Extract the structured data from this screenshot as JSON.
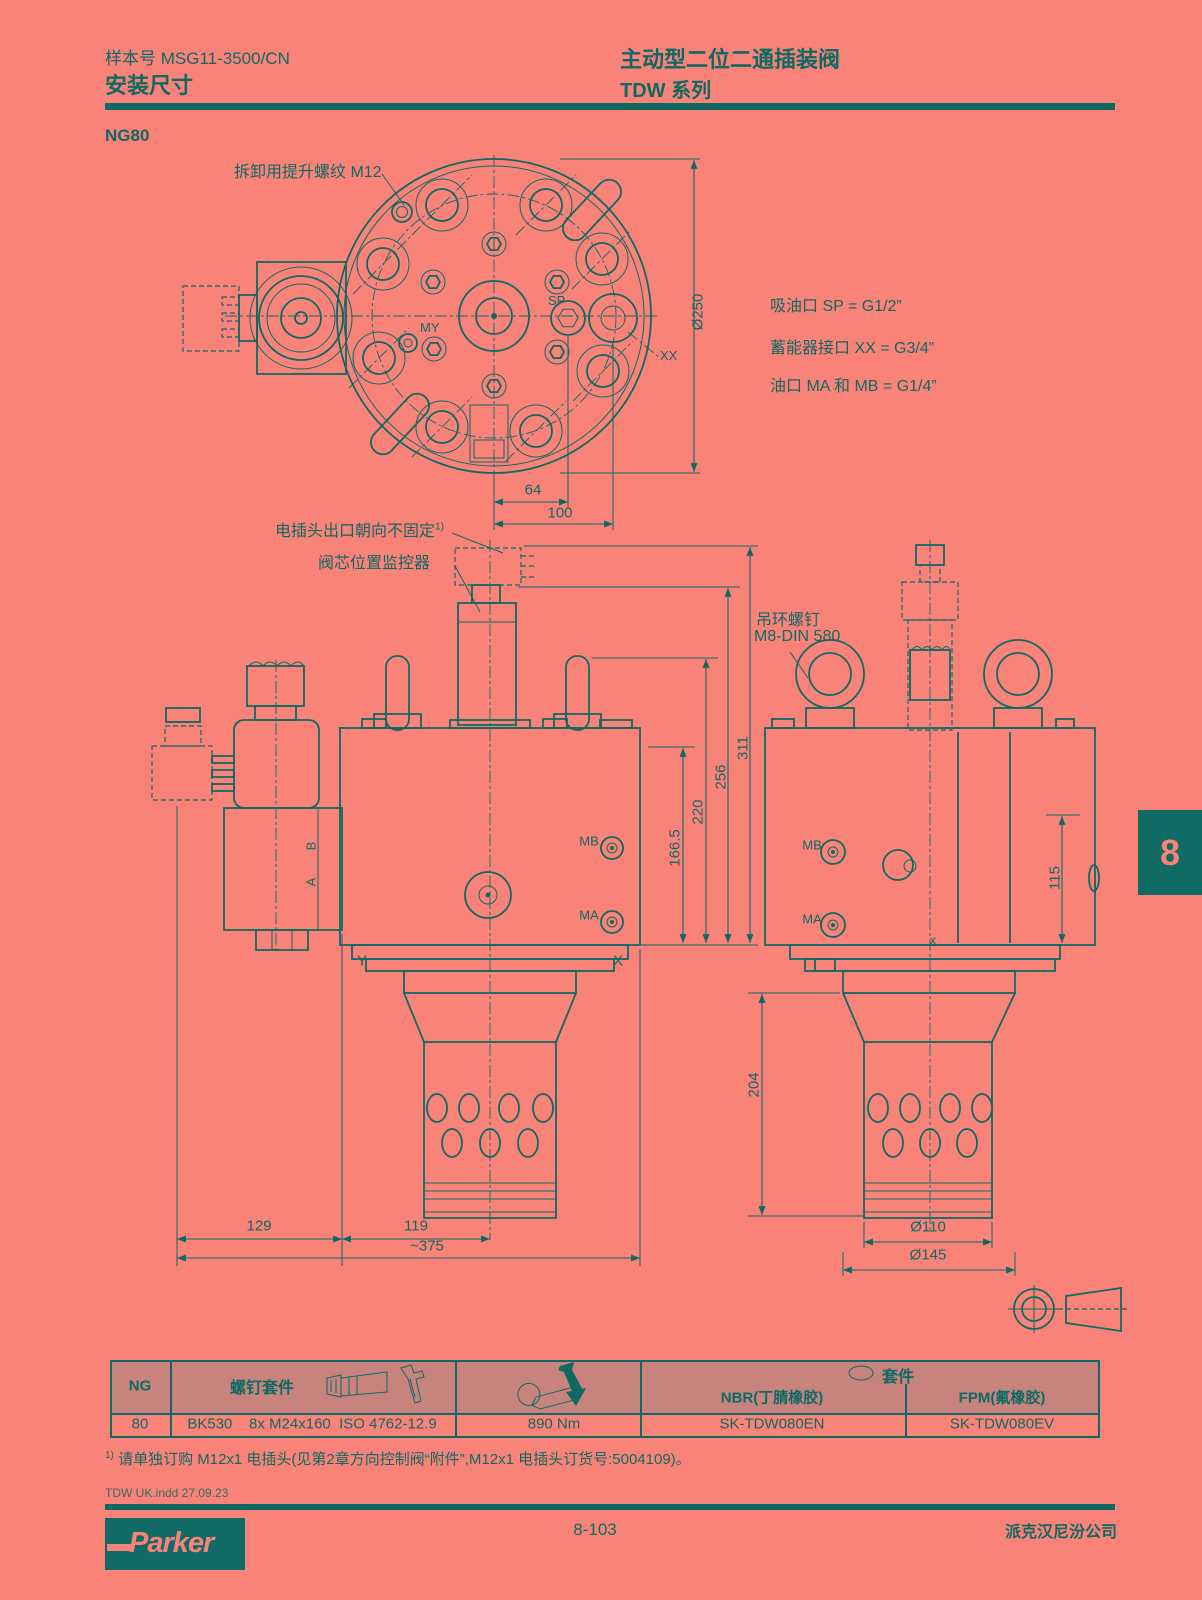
{
  "header": {
    "doc_no": "样本号 MSG11-3500/CN",
    "section": "安装尺寸",
    "title": "主动型二位二通插装阀",
    "series": "TDW 系列"
  },
  "page": {
    "size_code": "NG80",
    "chapter_tab": "8"
  },
  "callouts": {
    "lifting_thread": "拆卸用提升螺纹 M12",
    "plug_orientation": "电插头出口朝向不固定",
    "plug_sup": "1)",
    "spool_monitor": "阀芯位置监控器",
    "eye_bolt_1": "吊环螺钉",
    "eye_bolt_2": "M8-DIN 580"
  },
  "port_notes": {
    "sp": "吸油口 SP = G1/2”",
    "xx": "蓄能器接口 XX = G3/4”",
    "mamb": "油口 MA 和 MB = G1/4”"
  },
  "ports": {
    "sp": "SP",
    "xx": "XX",
    "my": "MY",
    "mb": "MB",
    "ma": "MA",
    "a": "A",
    "b": "B",
    "y": "Y",
    "x": "X",
    "x_lower": "x"
  },
  "dims": {
    "dia250": "Ø250",
    "w64": "64",
    "w100": "100",
    "h166": "166.5",
    "h220": "220",
    "h256": "256",
    "h311": "311",
    "h204": "204",
    "h115": "115",
    "w129": "129",
    "w119": "119",
    "w375": "~375",
    "dia110": "Ø110",
    "dia145": "Ø145"
  },
  "table": {
    "col_ng": "NG",
    "col_bolt_kit": "螺钉套件",
    "col_seal_kit": "套件",
    "col_nbr": "NBR(丁腈橡胶)",
    "col_fpm": "FPM(氟橡胶)",
    "row": {
      "ng": "80",
      "bolt_kit": "BK530    8x M24x160  ISO 4762-12.9",
      "torque": "890 Nm",
      "nbr": "SK-TDW080EN",
      "fpm": "SK-TDW080EV"
    }
  },
  "footnote": {
    "sup": "1)",
    "text": " 请单独订购 M12x1 电插头(见第2章方向控制阀“附件”,M12x1 电插头订货号:5004109)。"
  },
  "footer": {
    "file_note": "TDW UK.indd   27.09.23",
    "brand": "Parker",
    "page_no": "8-103",
    "company": "派克汉尼汾公司"
  }
}
